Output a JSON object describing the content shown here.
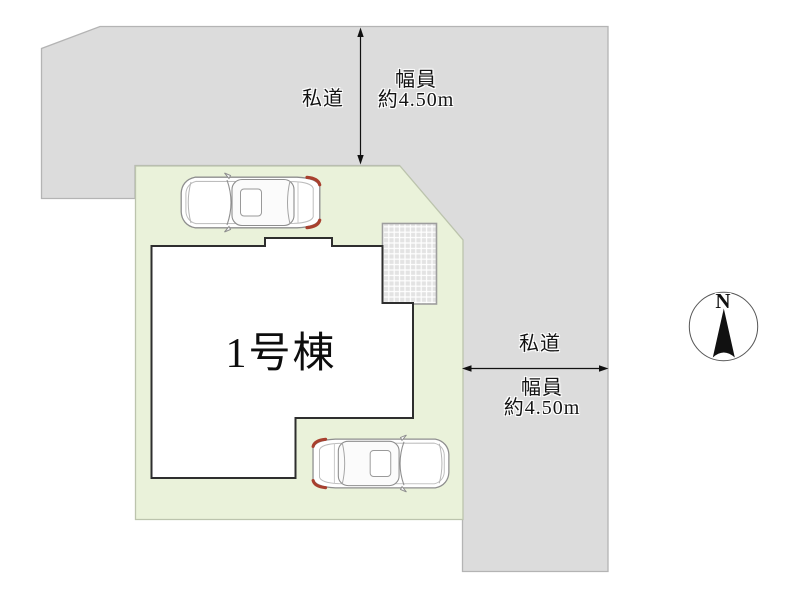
{
  "plan": {
    "building": {
      "label": "1号棟"
    },
    "roads": {
      "top": {
        "name": "私道",
        "width_label": "幅員",
        "width_value": "約4.50m"
      },
      "right": {
        "name": "私道",
        "width_label": "幅員",
        "width_value": "約4.50m"
      }
    },
    "compass": {
      "north": "N"
    },
    "colors": {
      "road_fill": "#dcdcdc",
      "road_border": "#b4b4b4",
      "plot_fill": "#eaf2da",
      "plot_border": "#bcc4ad",
      "house_fill": "#ffffff",
      "house_outline": "#2e2e2e",
      "tail_light": "#a8402e"
    }
  }
}
